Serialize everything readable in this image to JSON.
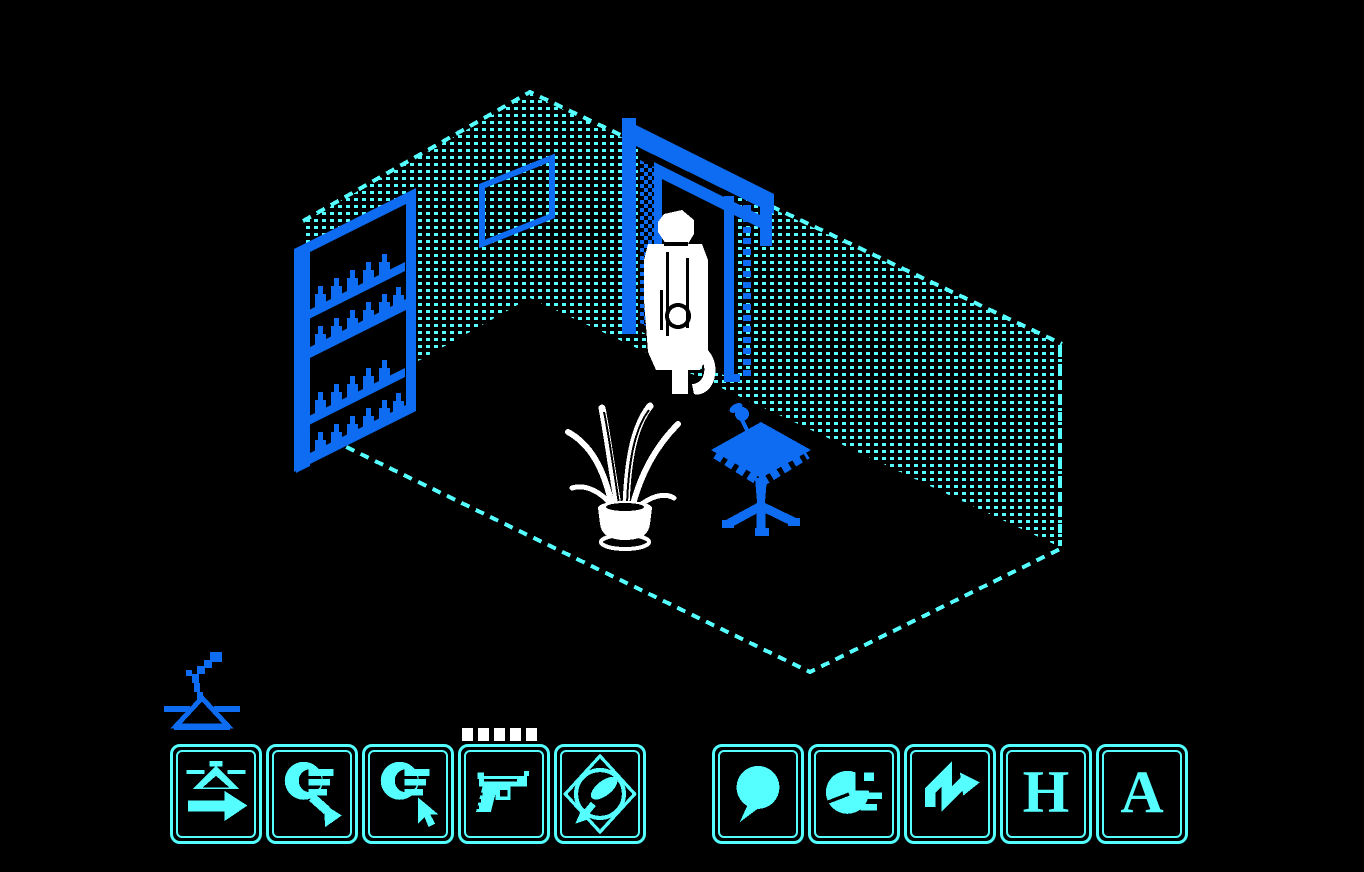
{
  "palette": {
    "background": "#000000",
    "cyan": "#55ffff",
    "blue": "#0e6cf2",
    "white": "#ffffff"
  },
  "scene": {
    "room": {
      "left_wall": "dithered wall with bookshelf and picture",
      "right_wall": "dithered wall with doorway",
      "floor": "dashed outline parallelogram"
    },
    "objects": [
      {
        "id": "bookshelf",
        "label": "double shelf unit with bottles"
      },
      {
        "id": "wall-picture",
        "label": "framed picture"
      },
      {
        "id": "doorway",
        "label": "open door frame"
      },
      {
        "id": "character",
        "label": "white figure in doorway"
      },
      {
        "id": "potted-plant",
        "label": "white potted plant"
      },
      {
        "id": "pedestal-table",
        "label": "blue pedestal table"
      }
    ]
  },
  "hud": {
    "ammo_dots": 5,
    "status_sprite": "lamp",
    "left_buttons": [
      {
        "id": "exit-button",
        "icon": "eject-arrow-icon",
        "label": ""
      },
      {
        "id": "drop-button",
        "icon": "hand-drop-arrow-icon",
        "label": ""
      },
      {
        "id": "take-button",
        "icon": "hand-pointer-icon",
        "label": ""
      },
      {
        "id": "gun-button",
        "icon": "pistol-icon",
        "label": ""
      },
      {
        "id": "mirror-button",
        "icon": "mirror-icon",
        "label": ""
      }
    ],
    "right_buttons": [
      {
        "id": "talk-button",
        "icon": "speech-bubble-icon",
        "label": ""
      },
      {
        "id": "clock-button",
        "icon": "clock-pie-icon",
        "label": ""
      },
      {
        "id": "action-button",
        "icon": "zigzag-arrow-icon",
        "label": ""
      },
      {
        "id": "h-button",
        "icon": "letter",
        "label": "H"
      },
      {
        "id": "a-button",
        "icon": "letter",
        "label": "A"
      }
    ]
  }
}
